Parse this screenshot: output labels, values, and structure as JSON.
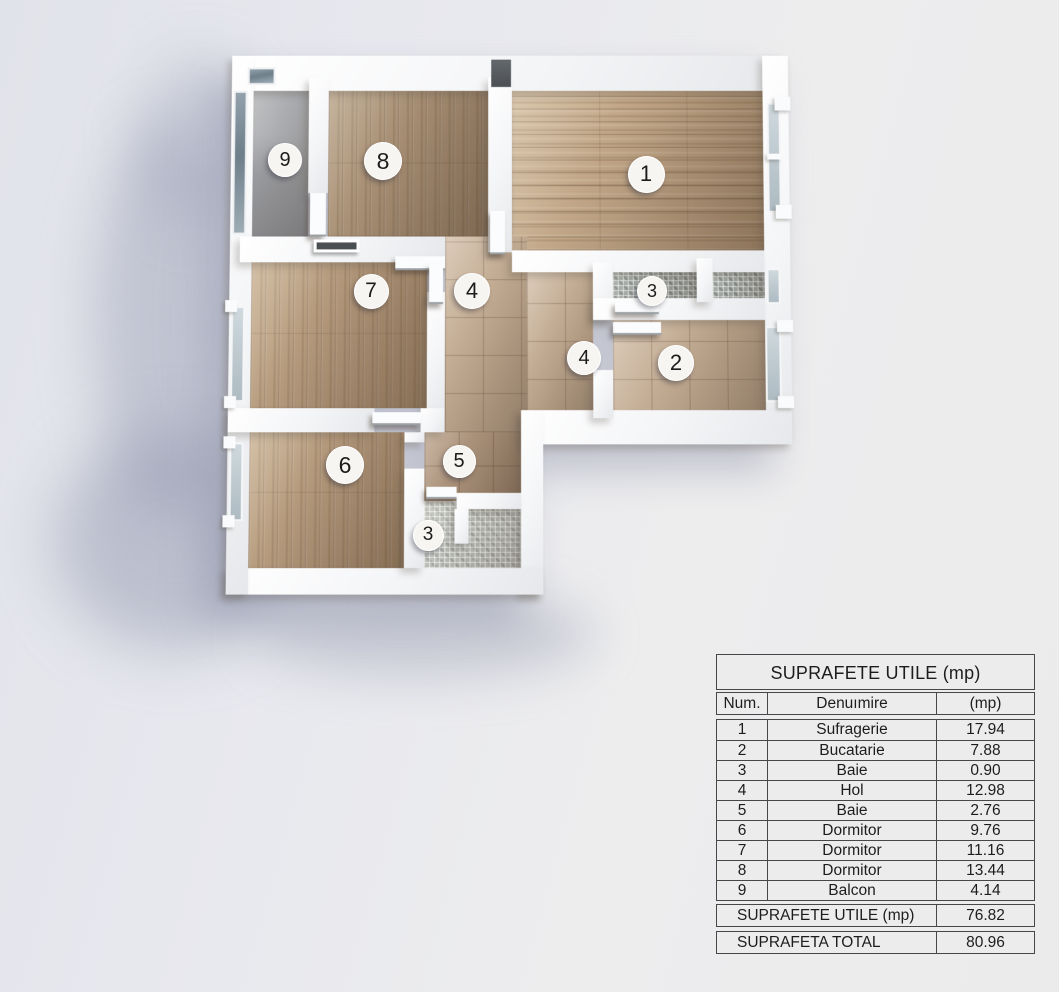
{
  "floor_plan": {
    "markers": [
      {
        "label": "9",
        "x": 285,
        "y": 160,
        "d": 34
      },
      {
        "label": "8",
        "x": 383,
        "y": 161,
        "d": 38
      },
      {
        "label": "1",
        "x": 646,
        "y": 174,
        "d": 37
      },
      {
        "label": "7",
        "x": 371,
        "y": 291,
        "d": 35
      },
      {
        "label": "4",
        "x": 472,
        "y": 291,
        "d": 36
      },
      {
        "label": "3",
        "x": 652,
        "y": 291,
        "d": 30
      },
      {
        "label": "4",
        "x": 584,
        "y": 358,
        "d": 34
      },
      {
        "label": "2",
        "x": 676,
        "y": 363,
        "d": 36
      },
      {
        "label": "6",
        "x": 345,
        "y": 465,
        "d": 38
      },
      {
        "label": "5",
        "x": 459,
        "y": 461,
        "d": 33
      },
      {
        "label": "3",
        "x": 428,
        "y": 535,
        "d": 31
      }
    ]
  },
  "table": {
    "title": "SUPRAFETE UTILE (mp)",
    "columns": [
      "Num.",
      "Denuımire",
      "(mp)"
    ],
    "rows": [
      [
        "1",
        "Sufragerie",
        "17.94"
      ],
      [
        "2",
        "Bucatarie",
        "7.88"
      ],
      [
        "3",
        "Baie",
        "0.90"
      ],
      [
        "4",
        "Hol",
        "12.98"
      ],
      [
        "5",
        "Baie",
        "2.76"
      ],
      [
        "6",
        "Dormitor",
        "9.76"
      ],
      [
        "7",
        "Dormitor",
        "11.16"
      ],
      [
        "8",
        "Dormitor",
        "13.44"
      ],
      [
        "9",
        "Balcon",
        "4.14"
      ]
    ],
    "totals": [
      {
        "label": "SUPRAFETE UTILE (mp)",
        "value": "76.82"
      },
      {
        "label": "SUPRAFETA TOTAL",
        "value": "80.96"
      }
    ]
  },
  "colors": {
    "page_bg": "#e8e9ed",
    "wall": "#f5f6f8",
    "wood": "#b2977a",
    "tile": "#c3ad97",
    "mosaic": "#9da39f",
    "concrete": "#9b9da1",
    "glass": "#b6c2c9",
    "marker_bg": "#f6f5f2",
    "table_bg": "#ececec",
    "table_border": "#474747",
    "text": "#1d1d1d"
  }
}
